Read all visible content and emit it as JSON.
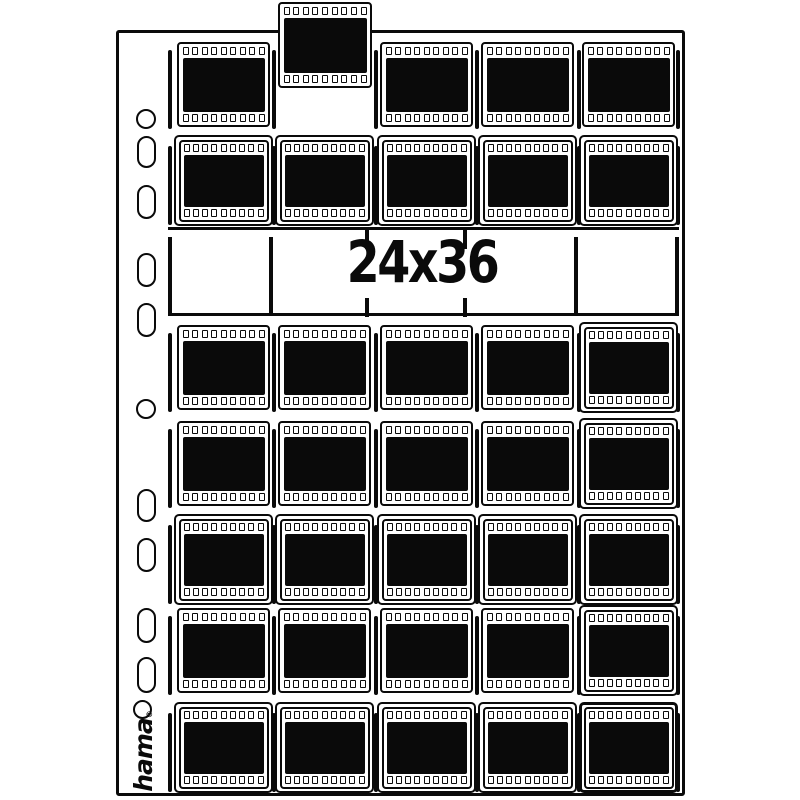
{
  "brand": {
    "name": "hama",
    "registered_mark": "®"
  },
  "format": {
    "label": "24x36"
  },
  "colors": {
    "ink": "#0a0a0a",
    "paper": "#ffffff"
  },
  "grid": {
    "columns_x": [
      177,
      278,
      380,
      481,
      582
    ],
    "frame_w": 93,
    "frame_h": 85,
    "sprockets_per_row": 9,
    "rows": [
      {
        "y": 42,
        "slots": [
          "frame",
          "empty",
          "frame",
          "frame",
          "frame"
        ]
      },
      {
        "y": 138,
        "slots": [
          "pocket",
          "pocket",
          "pocket",
          "pocket",
          "pocket"
        ]
      },
      {
        "y": 325,
        "slots": [
          "frame",
          "frame",
          "frame",
          "frame",
          "pocket"
        ]
      },
      {
        "y": 421,
        "slots": [
          "frame",
          "frame",
          "frame",
          "frame",
          "pocket"
        ]
      },
      {
        "y": 517,
        "slots": [
          "pocket",
          "pocket",
          "pocket",
          "pocket",
          "pocket"
        ]
      },
      {
        "y": 608,
        "slots": [
          "frame",
          "frame",
          "frame",
          "frame",
          "pocket"
        ]
      },
      {
        "y": 705,
        "slots": [
          "pocket",
          "pocket",
          "pocket",
          "pocket",
          "pocket-thick"
        ]
      }
    ],
    "bars_x": [
      168,
      272,
      373.5,
      475,
      576.5,
      676
    ],
    "popped_frame": {
      "x": 278,
      "y": 2
    }
  },
  "band": {
    "top_line": {
      "x": 168,
      "y": 227,
      "w": 511,
      "h": 2.5
    },
    "bottom_line": {
      "x": 168,
      "y": 313,
      "w": 511,
      "h": 3
    },
    "full_bars_x": [
      168,
      269,
      574,
      675
    ],
    "full_bars_y": 237,
    "full_bars_h": 79,
    "tick_bars_x": [
      365,
      463
    ],
    "tick_top_y": 230,
    "tick_bottom_y": 298,
    "tick_h": 19
  },
  "holes": [
    {
      "shape": "circle",
      "x": 136,
      "y": 109,
      "w": 20,
      "h": 20
    },
    {
      "shape": "oval",
      "x": 137,
      "y": 136,
      "w": 19,
      "h": 32
    },
    {
      "shape": "oval",
      "x": 137,
      "y": 185,
      "w": 19,
      "h": 34
    },
    {
      "shape": "oval",
      "x": 137,
      "y": 253,
      "w": 19,
      "h": 34
    },
    {
      "shape": "oval",
      "x": 137,
      "y": 303,
      "w": 19,
      "h": 34
    },
    {
      "shape": "circle",
      "x": 136,
      "y": 399,
      "w": 20,
      "h": 20
    },
    {
      "shape": "oval",
      "x": 137,
      "y": 489,
      "w": 19,
      "h": 33
    },
    {
      "shape": "oval",
      "x": 137,
      "y": 538,
      "w": 19,
      "h": 34
    },
    {
      "shape": "oval",
      "x": 137,
      "y": 608,
      "w": 19,
      "h": 35
    },
    {
      "shape": "oval",
      "x": 137,
      "y": 657,
      "w": 19,
      "h": 36
    },
    {
      "shape": "circle",
      "x": 133,
      "y": 700,
      "w": 19,
      "h": 19
    }
  ]
}
